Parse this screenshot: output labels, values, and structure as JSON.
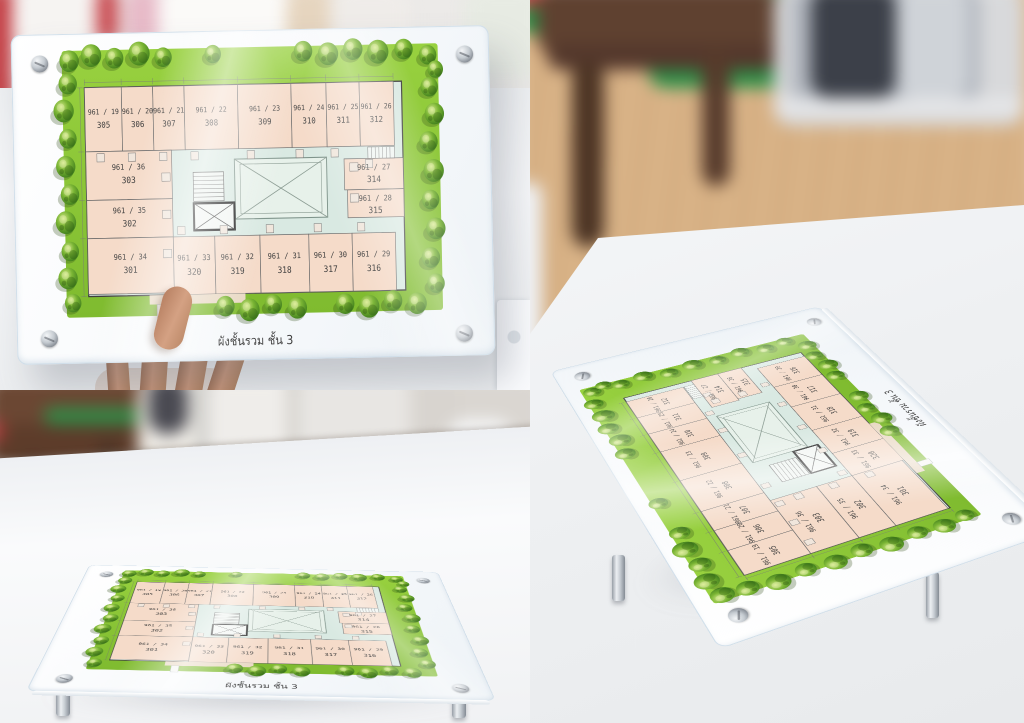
{
  "plan": {
    "caption": "ผังชั้นรวม ชั้น 3",
    "top_row": [
      {
        "unit": "961 / 19",
        "room": "305"
      },
      {
        "unit": "961 / 20",
        "room": "306"
      },
      {
        "unit": "961 / 21",
        "room": "307"
      },
      {
        "unit": "961 / 22",
        "room": "308"
      },
      {
        "unit": "961 / 23",
        "room": "309"
      },
      {
        "unit": "961 / 24",
        "room": "310"
      },
      {
        "unit": "961 / 25",
        "room": "311"
      },
      {
        "unit": "961 / 26",
        "room": "312"
      }
    ],
    "left_col": [
      {
        "unit": "961 / 36",
        "room": "303"
      },
      {
        "unit": "961 / 35",
        "room": "302"
      },
      {
        "unit": "961 / 34",
        "room": "301"
      }
    ],
    "right_col": [
      {
        "unit": "961 / 27",
        "room": "314"
      },
      {
        "unit": "961 / 28",
        "room": "315"
      }
    ],
    "bottom_row": [
      {
        "unit": "961 / 33",
        "room": "320"
      },
      {
        "unit": "961 / 32",
        "room": "319"
      },
      {
        "unit": "961 / 31",
        "room": "318"
      },
      {
        "unit": "961 / 30",
        "room": "317"
      },
      {
        "unit": "961 / 29",
        "room": "316"
      }
    ]
  },
  "colors": {
    "lawn_green": "#8dc63f",
    "unit_fill": "#f5dbc9",
    "corridor_mint": "#d9e9e2",
    "courtyard": "#e7f1ea",
    "sign_white": "#fafcfe",
    "tree_green": "#5a9e2f",
    "standoff_silver": "#c4cad0"
  }
}
